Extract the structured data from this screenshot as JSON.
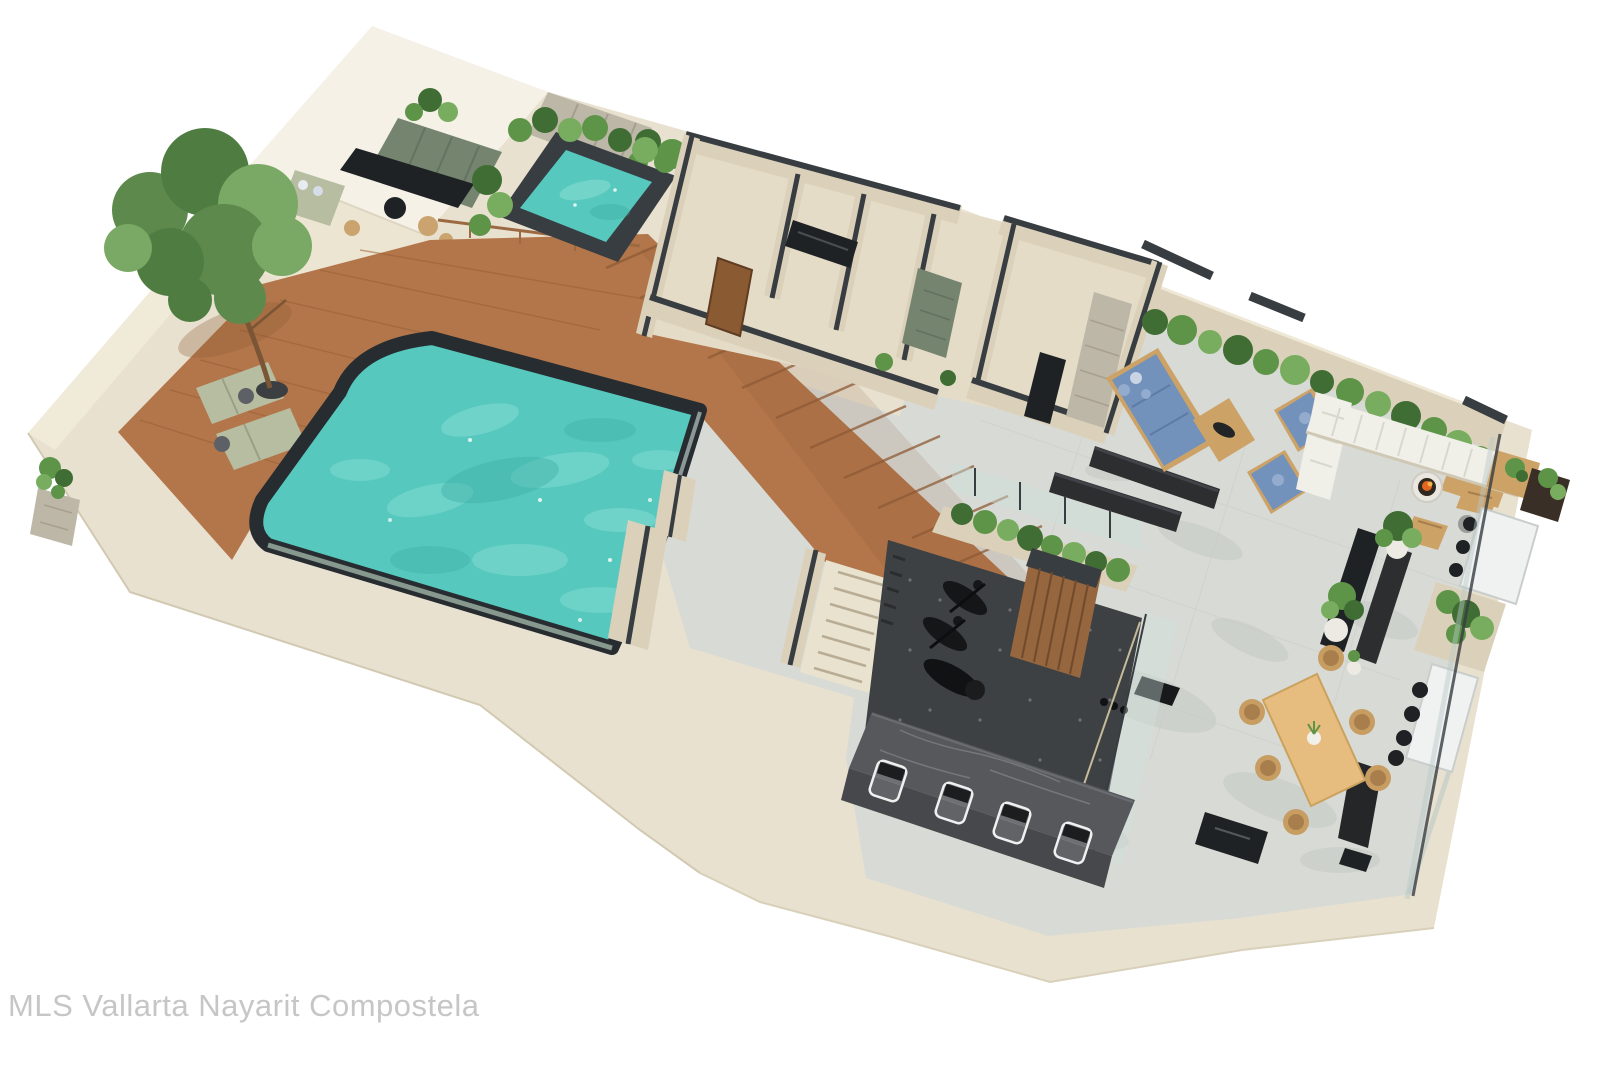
{
  "watermark": {
    "text": "MLS Vallarta Nayarit Compostela"
  },
  "scene": {
    "zones": [
      "rooftop-bar",
      "plunge-pool",
      "wood-deck",
      "tree-garden",
      "main-pool",
      "bathroom-block",
      "interior-stairs",
      "lounge-terrace",
      "outdoor-gym",
      "bar-counter",
      "dining-terrace",
      "outdoor-kitchen"
    ]
  },
  "colors": {
    "background": "#ffffff",
    "wall_cream": "#e8e1cf",
    "wall_cream_light": "#f0ead9",
    "wall_beige": "#dbd1ba",
    "roof_white": "#f5f1e7",
    "roof_face": "#ece5d2",
    "wall_charcoal": "#383d42",
    "tile_gray": "#d8dad5",
    "tile_shadow": "#c5cac3",
    "pool_water": "#57c8be",
    "pool_water_light": "#8fe0d6",
    "pool_water_dark": "#36a89e",
    "pool_rim": "#272c30",
    "wood_deck": "#b3764a",
    "wood_plank": "#9a6037",
    "wood_step": "#8e5a35",
    "plant_green": "#3f6d33",
    "plant_green_mid": "#5d9448",
    "plant_green_light": "#78ad5f",
    "tree_green_dark": "#4f7c40",
    "tree_green": "#5d8a4c",
    "tree_green_light": "#79a964",
    "stone_green": "#74846f",
    "stone_gray": "#bdb7a8",
    "counter_black": "#1f2224",
    "furniture_black": "#2c2e30",
    "sofa_blue": "#7291bb",
    "sofa_blue_light": "#93abcd",
    "sofa_white": "#f0efe8",
    "wood_furniture": "#cda267",
    "wood_table": "#e7bd7f",
    "wicker_tan": "#c79d62",
    "wicker_dark": "#a87f4c",
    "sage_green": "#b7bda0",
    "gym_floor": "#3e4143",
    "marble_dark": "#56585c",
    "marble_white": "#f0f2f2",
    "fire_orange": "#e2661f",
    "glass_tint": "#cfe0dc",
    "stump_tan": "#caa36f",
    "watermark_gray": "#c6c6c6"
  }
}
